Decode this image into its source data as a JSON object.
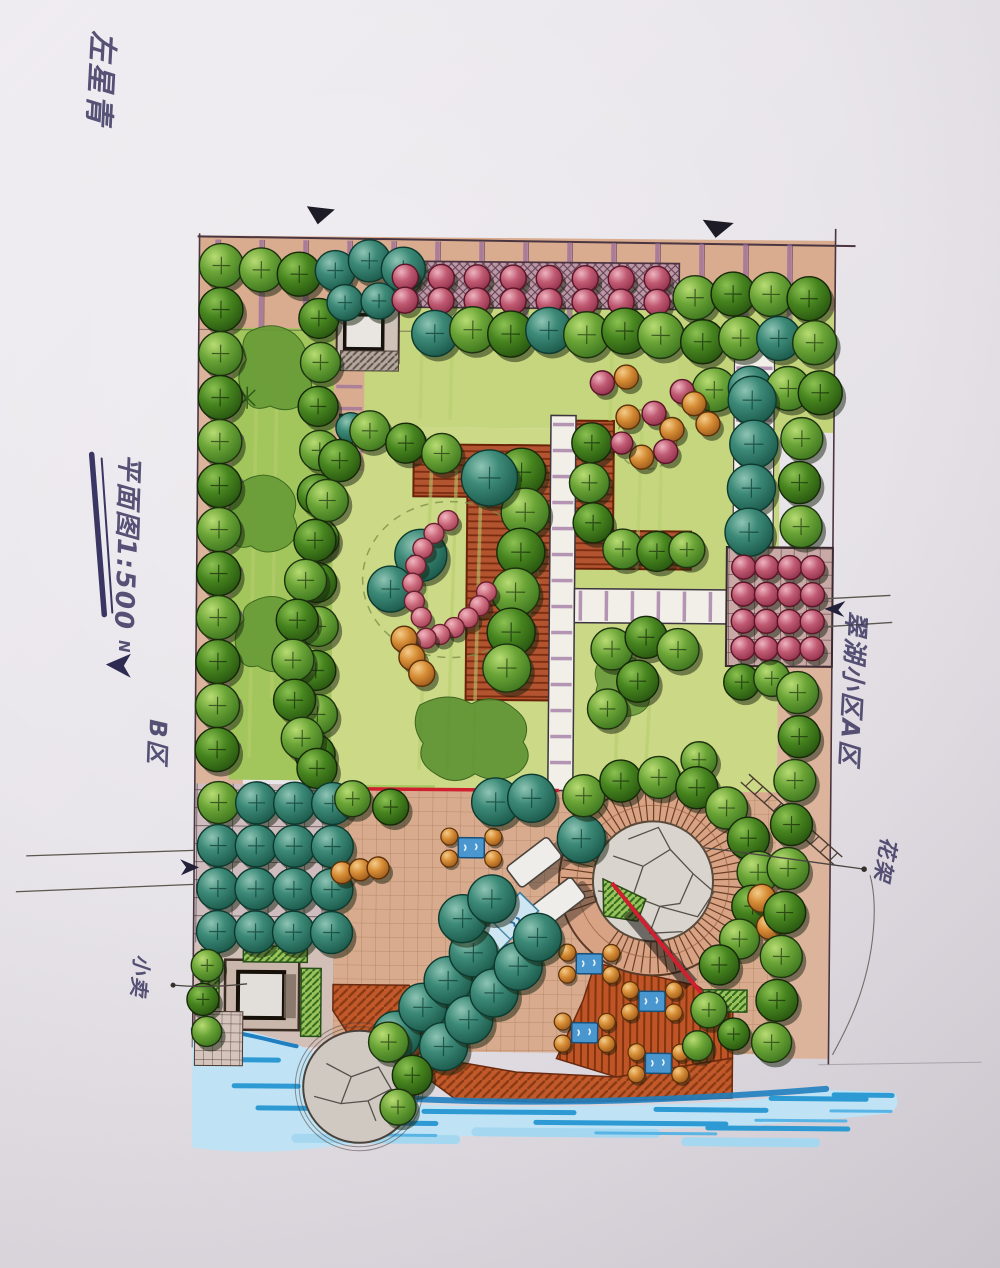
{
  "annotations": {
    "signature": "左星青",
    "plan_scale": "平面图1:500",
    "north": "N",
    "zone_b": "B区",
    "adjacent_district": "翠湖小区A区",
    "pergola": "花架",
    "kiosk": "小卖"
  },
  "palette": {
    "paper": "#e9e6eb",
    "road_tan": "#d9ab8f",
    "path_light": "#dcb49c",
    "lawn_bright": "#a3c65c",
    "lawn_yellow": "#ccd986",
    "lawn_soft": "#c6d67e",
    "tree_green": "#5c9a2e",
    "tree_green_dark": "#2f641a",
    "tree_teal": "#2c7b6b",
    "tree_pink": "#bb5068",
    "shrub_orange": "#d2872f",
    "terracotta": "#b35430",
    "deck_red": "#c2592a",
    "water": "#5bbae8",
    "water_dark": "#2d9ad4",
    "stone": "#d9d4cd",
    "plaza_mauve": "#cfbcbe",
    "tick_purple": "#9a6e9e",
    "ink": "#3a3040",
    "red_line": "#d01f2e",
    "handwriting": "#3c3760"
  }
}
